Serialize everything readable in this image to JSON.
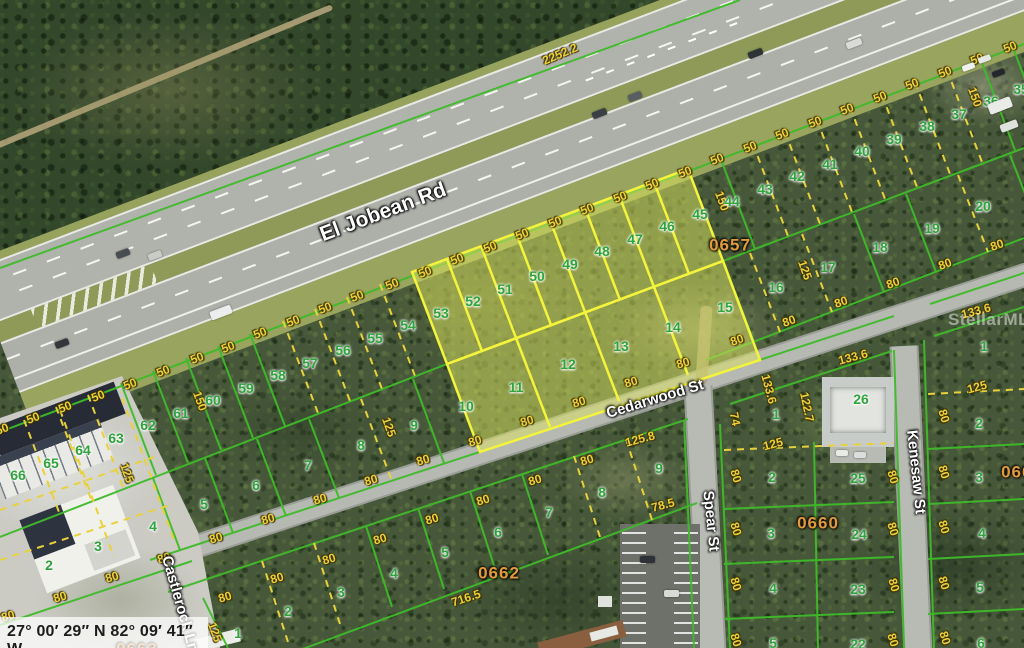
{
  "map": {
    "coordinates": "27° 00′ 29″ N 82° 09′ 41″ W",
    "watermark": "StellarMLS",
    "streets": [
      {
        "t": "El Jobean Rd",
        "x": 383,
        "y": 212,
        "r": -20.5,
        "s": 21
      },
      {
        "t": "Cedarwood St",
        "x": 655,
        "y": 399,
        "r": -17,
        "s": 15
      },
      {
        "t": "Spear St",
        "x": 711,
        "y": 521,
        "r": 84,
        "s": 15
      },
      {
        "t": "Kenesaw St",
        "x": 916,
        "y": 472,
        "r": 84,
        "s": 15
      },
      {
        "t": "Castlerock Ln",
        "x": 180,
        "y": 604,
        "r": 74,
        "s": 15
      }
    ],
    "blocks": [
      {
        "t": "0657",
        "x": 730,
        "y": 245
      },
      {
        "t": "0660",
        "x": 818,
        "y": 523
      },
      {
        "t": "0662",
        "x": 499,
        "y": 573
      },
      {
        "t": "0661",
        "x": 1022,
        "y": 472
      },
      {
        "t": "0663",
        "x": 137,
        "y": 649
      }
    ],
    "highlighted_lots": [
      "46",
      "47",
      "48",
      "49",
      "50",
      "51",
      "52",
      "53",
      "11",
      "12",
      "13",
      "14"
    ],
    "lots": [
      {
        "t": "53",
        "x": 441,
        "y": 313
      },
      {
        "t": "52",
        "x": 473,
        "y": 301
      },
      {
        "t": "51",
        "x": 505,
        "y": 289
      },
      {
        "t": "50",
        "x": 537,
        "y": 276
      },
      {
        "t": "49",
        "x": 570,
        "y": 264
      },
      {
        "t": "48",
        "x": 602,
        "y": 251
      },
      {
        "t": "47",
        "x": 635,
        "y": 239
      },
      {
        "t": "46",
        "x": 667,
        "y": 226
      },
      {
        "t": "45",
        "x": 700,
        "y": 214
      },
      {
        "t": "44",
        "x": 732,
        "y": 201
      },
      {
        "t": "43",
        "x": 765,
        "y": 189
      },
      {
        "t": "42",
        "x": 797,
        "y": 176
      },
      {
        "t": "41",
        "x": 830,
        "y": 164
      },
      {
        "t": "40",
        "x": 862,
        "y": 151
      },
      {
        "t": "39",
        "x": 894,
        "y": 139
      },
      {
        "t": "38",
        "x": 927,
        "y": 126
      },
      {
        "t": "37",
        "x": 959,
        "y": 114
      },
      {
        "t": "36",
        "x": 991,
        "y": 101
      },
      {
        "t": "35",
        "x": 1021,
        "y": 89
      },
      {
        "t": "54",
        "x": 408,
        "y": 325
      },
      {
        "t": "55",
        "x": 375,
        "y": 338
      },
      {
        "t": "56",
        "x": 343,
        "y": 350
      },
      {
        "t": "57",
        "x": 310,
        "y": 363
      },
      {
        "t": "58",
        "x": 278,
        "y": 375
      },
      {
        "t": "59",
        "x": 246,
        "y": 388
      },
      {
        "t": "60",
        "x": 213,
        "y": 400
      },
      {
        "t": "61",
        "x": 181,
        "y": 413
      },
      {
        "t": "62",
        "x": 148,
        "y": 425
      },
      {
        "t": "63",
        "x": 116,
        "y": 438
      },
      {
        "t": "64",
        "x": 83,
        "y": 450
      },
      {
        "t": "65",
        "x": 51,
        "y": 463
      },
      {
        "t": "66",
        "x": 18,
        "y": 475
      },
      {
        "t": "14",
        "x": 673,
        "y": 327
      },
      {
        "t": "13",
        "x": 621,
        "y": 346
      },
      {
        "t": "12",
        "x": 568,
        "y": 364
      },
      {
        "t": "11",
        "x": 516,
        "y": 387
      },
      {
        "t": "10",
        "x": 466,
        "y": 406
      },
      {
        "t": "9",
        "x": 414,
        "y": 425
      },
      {
        "t": "8",
        "x": 361,
        "y": 445
      },
      {
        "t": "7",
        "x": 308,
        "y": 465
      },
      {
        "t": "6",
        "x": 256,
        "y": 485
      },
      {
        "t": "5",
        "x": 204,
        "y": 504
      },
      {
        "t": "4",
        "x": 153,
        "y": 526
      },
      {
        "t": "3",
        "x": 98,
        "y": 546
      },
      {
        "t": "2",
        "x": 49,
        "y": 565
      },
      {
        "t": "15",
        "x": 725,
        "y": 307
      },
      {
        "t": "16",
        "x": 776,
        "y": 287
      },
      {
        "t": "17",
        "x": 828,
        "y": 267
      },
      {
        "t": "18",
        "x": 880,
        "y": 247
      },
      {
        "t": "19",
        "x": 932,
        "y": 228
      },
      {
        "t": "20",
        "x": 983,
        "y": 206
      },
      {
        "t": "1",
        "x": 238,
        "y": 633
      },
      {
        "t": "2",
        "x": 288,
        "y": 611
      },
      {
        "t": "3",
        "x": 341,
        "y": 592
      },
      {
        "t": "4",
        "x": 394,
        "y": 573
      },
      {
        "t": "5",
        "x": 445,
        "y": 552
      },
      {
        "t": "6",
        "x": 498,
        "y": 532
      },
      {
        "t": "7",
        "x": 549,
        "y": 512
      },
      {
        "t": "8",
        "x": 602,
        "y": 492
      },
      {
        "t": "9",
        "x": 659,
        "y": 468
      },
      {
        "t": "1",
        "x": 776,
        "y": 414
      },
      {
        "t": "2",
        "x": 772,
        "y": 477
      },
      {
        "t": "3",
        "x": 771,
        "y": 533
      },
      {
        "t": "4",
        "x": 773,
        "y": 588
      },
      {
        "t": "5",
        "x": 773,
        "y": 643
      },
      {
        "t": "26",
        "x": 861,
        "y": 399
      },
      {
        "t": "25",
        "x": 858,
        "y": 478
      },
      {
        "t": "24",
        "x": 859,
        "y": 534
      },
      {
        "t": "23",
        "x": 858,
        "y": 589
      },
      {
        "t": "22",
        "x": 858,
        "y": 644
      },
      {
        "t": "1",
        "x": 984,
        "y": 346
      },
      {
        "t": "2",
        "x": 979,
        "y": 423
      },
      {
        "t": "3",
        "x": 979,
        "y": 477
      },
      {
        "t": "4",
        "x": 982,
        "y": 533
      },
      {
        "t": "5",
        "x": 980,
        "y": 587
      },
      {
        "t": "6",
        "x": 981,
        "y": 643
      }
    ],
    "dims": [
      {
        "t": "2252.2",
        "x": 560,
        "y": 54,
        "r": -23
      },
      {
        "t": "50",
        "x": 2,
        "y": 429,
        "r": -21
      },
      {
        "t": "50",
        "x": 33,
        "y": 418,
        "r": -21
      },
      {
        "t": "50",
        "x": 65,
        "y": 407,
        "r": -21
      },
      {
        "t": "50",
        "x": 98,
        "y": 396,
        "r": -21
      },
      {
        "t": "50",
        "x": 130,
        "y": 384,
        "r": -21
      },
      {
        "t": "50",
        "x": 163,
        "y": 371,
        "r": -21
      },
      {
        "t": "50",
        "x": 197,
        "y": 358,
        "r": -21
      },
      {
        "t": "50",
        "x": 228,
        "y": 347,
        "r": -21
      },
      {
        "t": "50",
        "x": 260,
        "y": 333,
        "r": -21
      },
      {
        "t": "50",
        "x": 293,
        "y": 321,
        "r": -21
      },
      {
        "t": "50",
        "x": 325,
        "y": 308,
        "r": -21
      },
      {
        "t": "50",
        "x": 357,
        "y": 296,
        "r": -21
      },
      {
        "t": "50",
        "x": 392,
        "y": 284,
        "r": -21
      },
      {
        "t": "50",
        "x": 425,
        "y": 272,
        "r": -21
      },
      {
        "t": "50",
        "x": 457,
        "y": 259,
        "r": -21
      },
      {
        "t": "50",
        "x": 490,
        "y": 247,
        "r": -21
      },
      {
        "t": "50",
        "x": 522,
        "y": 234,
        "r": -21
      },
      {
        "t": "50",
        "x": 555,
        "y": 222,
        "r": -21
      },
      {
        "t": "50",
        "x": 587,
        "y": 209,
        "r": -21
      },
      {
        "t": "50",
        "x": 620,
        "y": 197,
        "r": -21
      },
      {
        "t": "50",
        "x": 652,
        "y": 184,
        "r": -21
      },
      {
        "t": "50",
        "x": 685,
        "y": 172,
        "r": -21
      },
      {
        "t": "50",
        "x": 717,
        "y": 159,
        "r": -21
      },
      {
        "t": "50",
        "x": 750,
        "y": 147,
        "r": -21
      },
      {
        "t": "50",
        "x": 782,
        "y": 134,
        "r": -21
      },
      {
        "t": "50",
        "x": 815,
        "y": 122,
        "r": -21
      },
      {
        "t": "50",
        "x": 847,
        "y": 109,
        "r": -21
      },
      {
        "t": "50",
        "x": 880,
        "y": 97,
        "r": -21
      },
      {
        "t": "50",
        "x": 912,
        "y": 84,
        "r": -21
      },
      {
        "t": "50",
        "x": 945,
        "y": 72,
        "r": -21
      },
      {
        "t": "50",
        "x": 977,
        "y": 59,
        "r": -21
      },
      {
        "t": "50",
        "x": 1010,
        "y": 47,
        "r": -21
      },
      {
        "t": "80",
        "x": 8,
        "y": 616,
        "r": -17
      },
      {
        "t": "80",
        "x": 60,
        "y": 597,
        "r": -17
      },
      {
        "t": "80",
        "x": 112,
        "y": 577,
        "r": -17
      },
      {
        "t": "80",
        "x": 164,
        "y": 558,
        "r": -17
      },
      {
        "t": "80",
        "x": 216,
        "y": 538,
        "r": -17
      },
      {
        "t": "80",
        "x": 268,
        "y": 519,
        "r": -17
      },
      {
        "t": "80",
        "x": 320,
        "y": 499,
        "r": -17
      },
      {
        "t": "80",
        "x": 371,
        "y": 480,
        "r": -17
      },
      {
        "t": "80",
        "x": 423,
        "y": 460,
        "r": -17
      },
      {
        "t": "80",
        "x": 475,
        "y": 441,
        "r": -17
      },
      {
        "t": "80",
        "x": 527,
        "y": 421,
        "r": -17
      },
      {
        "t": "80",
        "x": 579,
        "y": 402,
        "r": -17
      },
      {
        "t": "80",
        "x": 631,
        "y": 382,
        "r": -17
      },
      {
        "t": "80",
        "x": 683,
        "y": 363,
        "r": -17
      },
      {
        "t": "80",
        "x": 225,
        "y": 597,
        "r": -17
      },
      {
        "t": "80",
        "x": 277,
        "y": 578,
        "r": -17
      },
      {
        "t": "80",
        "x": 329,
        "y": 559,
        "r": -17
      },
      {
        "t": "80",
        "x": 380,
        "y": 539,
        "r": -17
      },
      {
        "t": "80",
        "x": 432,
        "y": 519,
        "r": -17
      },
      {
        "t": "80",
        "x": 483,
        "y": 500,
        "r": -17
      },
      {
        "t": "80",
        "x": 535,
        "y": 480,
        "r": -17
      },
      {
        "t": "80",
        "x": 587,
        "y": 460,
        "r": -17
      },
      {
        "t": "80",
        "x": 737,
        "y": 340,
        "r": -19
      },
      {
        "t": "80",
        "x": 789,
        "y": 321,
        "r": -19
      },
      {
        "t": "80",
        "x": 841,
        "y": 302,
        "r": -19
      },
      {
        "t": "80",
        "x": 893,
        "y": 283,
        "r": -19
      },
      {
        "t": "80",
        "x": 945,
        "y": 264,
        "r": -19
      },
      {
        "t": "80",
        "x": 997,
        "y": 245,
        "r": -19
      },
      {
        "t": "80",
        "x": 736,
        "y": 476,
        "r": 73
      },
      {
        "t": "80",
        "x": 736,
        "y": 529,
        "r": 73
      },
      {
        "t": "80",
        "x": 736,
        "y": 584,
        "r": 73
      },
      {
        "t": "80",
        "x": 736,
        "y": 640,
        "r": 73
      },
      {
        "t": "80",
        "x": 893,
        "y": 477,
        "r": 73
      },
      {
        "t": "80",
        "x": 893,
        "y": 529,
        "r": 73
      },
      {
        "t": "80",
        "x": 894,
        "y": 585,
        "r": 73
      },
      {
        "t": "80",
        "x": 893,
        "y": 640,
        "r": 73
      },
      {
        "t": "80",
        "x": 944,
        "y": 472,
        "r": 73
      },
      {
        "t": "80",
        "x": 944,
        "y": 527,
        "r": 73
      },
      {
        "t": "80",
        "x": 944,
        "y": 583,
        "r": 73
      },
      {
        "t": "80",
        "x": 945,
        "y": 638,
        "r": 73
      },
      {
        "t": "80",
        "x": 944,
        "y": 416,
        "r": 73
      },
      {
        "t": "150",
        "x": 200,
        "y": 401,
        "r": 70
      },
      {
        "t": "150",
        "x": 722,
        "y": 201,
        "r": 70
      },
      {
        "t": "150",
        "x": 975,
        "y": 97,
        "r": 70
      },
      {
        "t": "125",
        "x": 773,
        "y": 444,
        "r": -15
      },
      {
        "t": "125",
        "x": 977,
        "y": 387,
        "r": -15
      },
      {
        "t": "125",
        "x": 389,
        "y": 427,
        "r": 70
      },
      {
        "t": "125",
        "x": 127,
        "y": 473,
        "r": 70
      },
      {
        "t": "125",
        "x": 215,
        "y": 632,
        "r": 70
      },
      {
        "t": "125",
        "x": 805,
        "y": 270,
        "r": 70
      },
      {
        "t": "133.6",
        "x": 976,
        "y": 311,
        "r": -15
      },
      {
        "t": "133.6",
        "x": 853,
        "y": 357,
        "r": -15
      },
      {
        "t": "133.6",
        "x": 769,
        "y": 389,
        "r": 75
      },
      {
        "t": "122.7",
        "x": 807,
        "y": 407,
        "r": 78
      },
      {
        "t": "74",
        "x": 735,
        "y": 419,
        "r": 78
      },
      {
        "t": "78.5",
        "x": 663,
        "y": 505,
        "r": -15
      },
      {
        "t": "125.8",
        "x": 640,
        "y": 439,
        "r": -15
      },
      {
        "t": "716.5",
        "x": 466,
        "y": 598,
        "r": -18
      }
    ],
    "colors": {
      "parcel_line_green": "#3fbb2a",
      "lot_line_yellow_dashed": "#e8d23c",
      "highlight_yellow": "#f4f43c",
      "lot_number_green": "#2fa33c",
      "dimension_yellow": "#eccf3a",
      "block_number_orange": "#e09a40"
    }
  }
}
